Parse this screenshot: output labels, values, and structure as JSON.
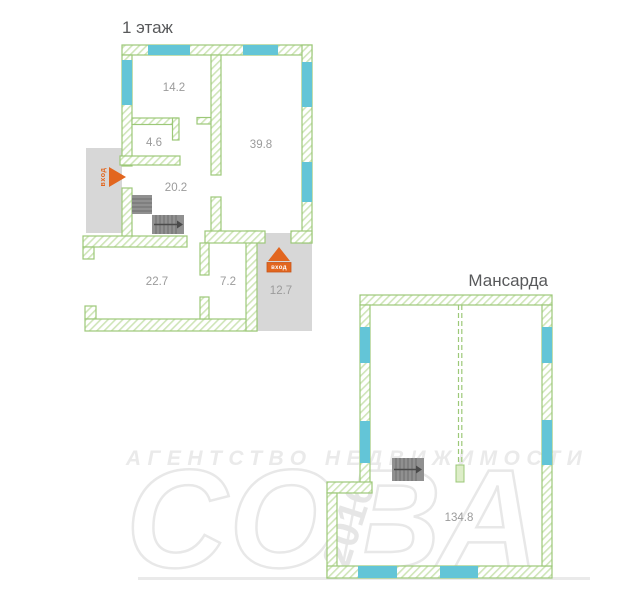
{
  "floor1": {
    "title": "1 этаж",
    "rooms": [
      {
        "area": "14.2"
      },
      {
        "area": "4.6"
      },
      {
        "area": "39.8"
      },
      {
        "area": "20.2"
      },
      {
        "area": "22.7"
      },
      {
        "area": "7.2"
      },
      {
        "area": "12.7"
      }
    ],
    "entrance_side_label": "вход",
    "entrance_main_label": "вход"
  },
  "attic": {
    "title": "Мансарда",
    "room_area": "134.8"
  },
  "watermark": {
    "agency": "АГЕНТСТВО НЕДВИЖИМОСТИ",
    "brand": "СОВА",
    "year": "2016"
  },
  "colors": {
    "wall_outline_green": "#9cc878",
    "wall_hatch_green": "#cfe5b8",
    "window_cyan": "#63c5d7",
    "porch_gray": "#d7d7d7",
    "stairs_gray": "#909090",
    "entrance_orange": "#e2661f",
    "room_label_gray": "#9b9b9b",
    "title_gray": "#58595b",
    "watermark_gray": "#e9e9e9"
  }
}
